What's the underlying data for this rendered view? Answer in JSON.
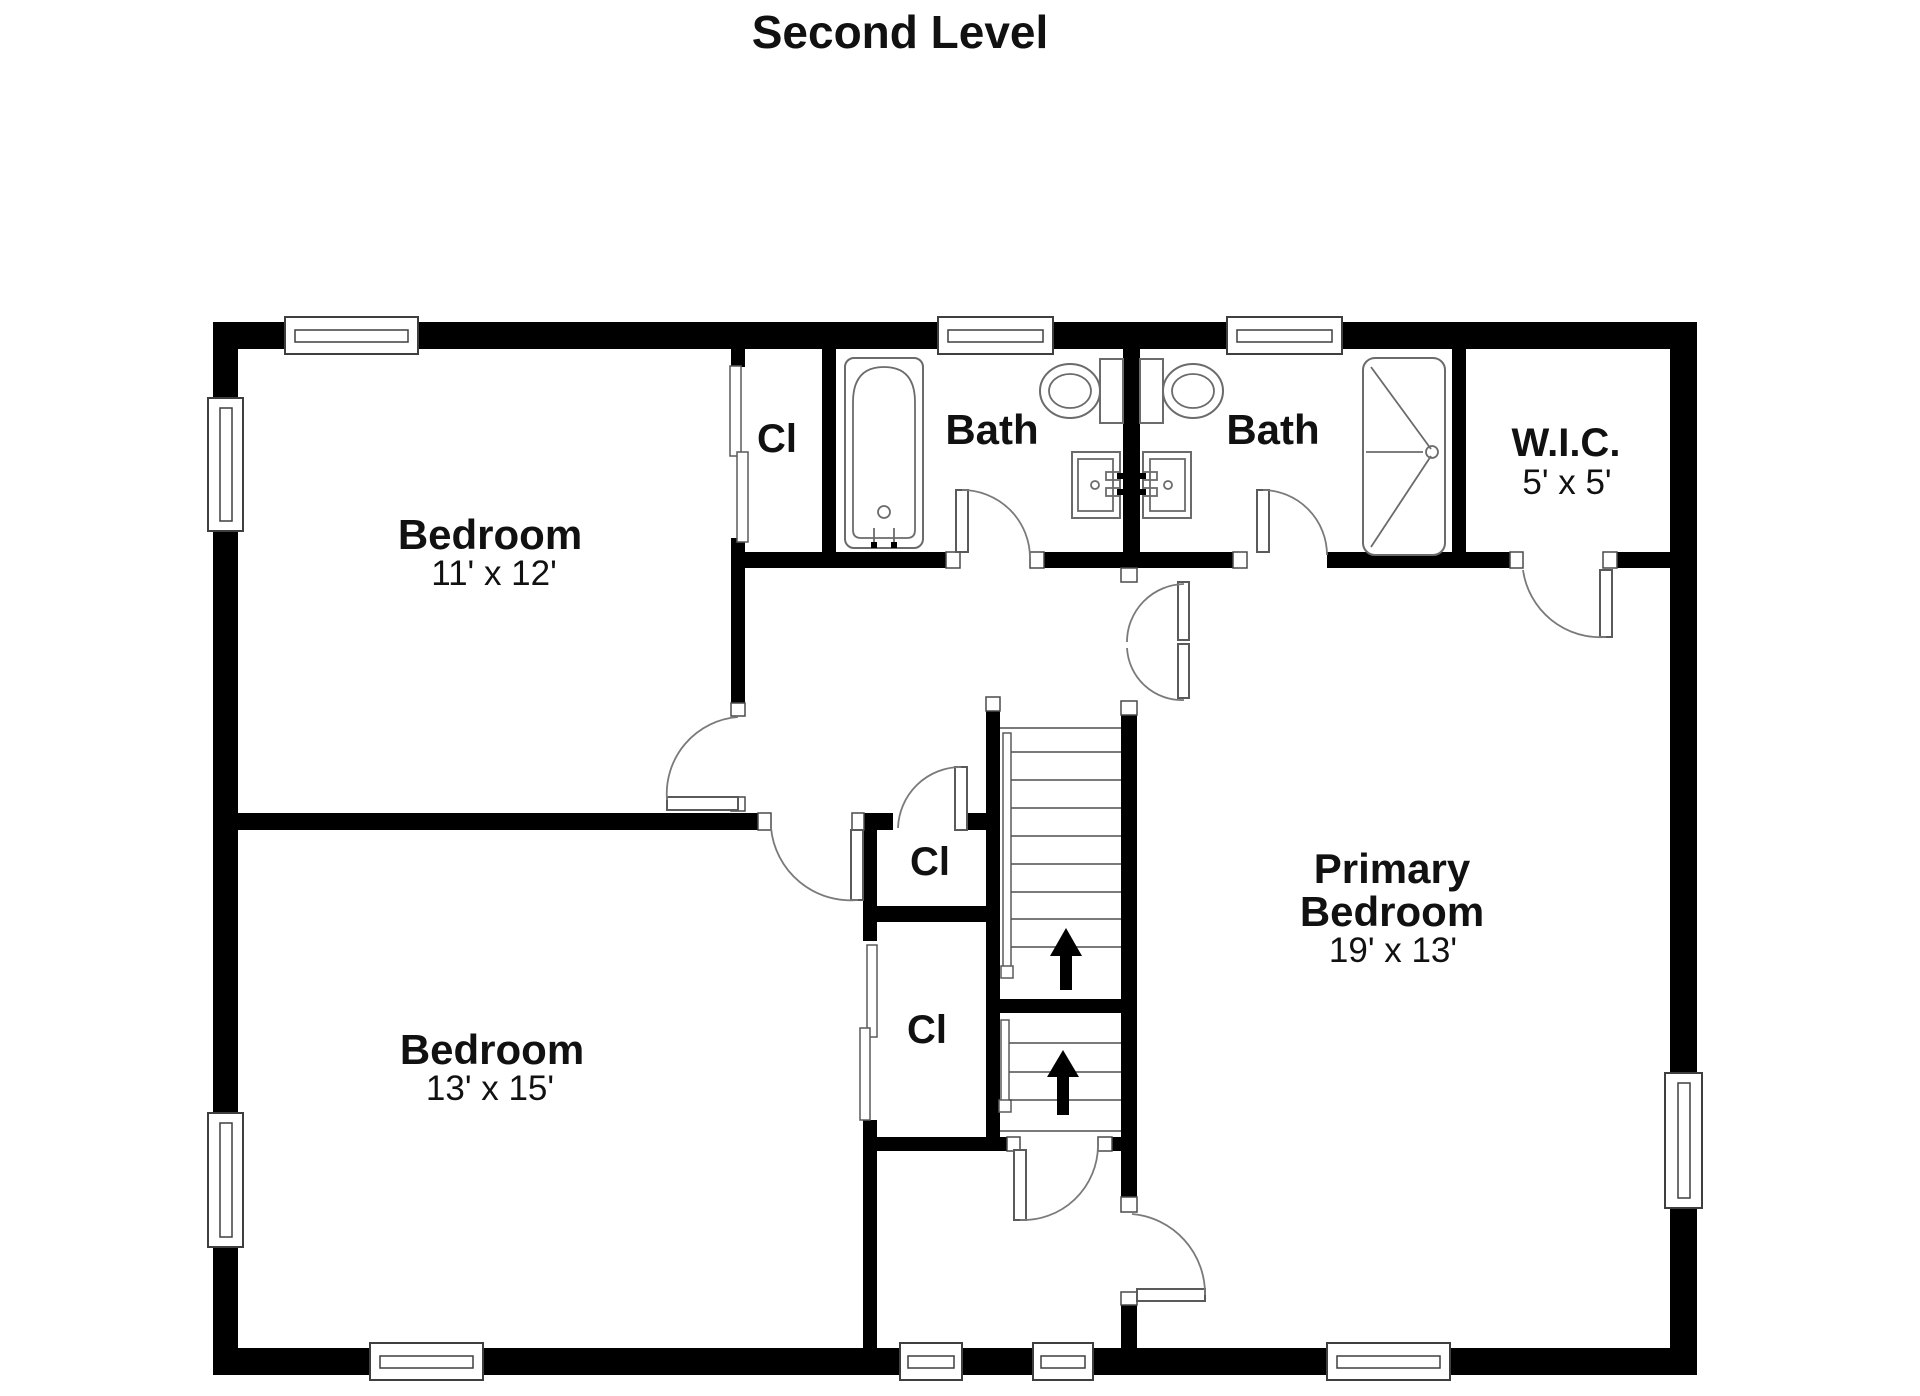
{
  "title": "Second Level",
  "colors": {
    "wall": "#000000",
    "thin_line": "#777777",
    "background": "#ffffff",
    "text": "#111111"
  },
  "rooms": {
    "bedroom_top": {
      "name": "Bedroom",
      "dims": "11' x 12'"
    },
    "bedroom_bottom": {
      "name": "Bedroom",
      "dims": "13' x 15'"
    },
    "primary_bedroom": {
      "line1": "Primary",
      "line2": "Bedroom",
      "dims": "19' x 13'"
    },
    "bath_left": {
      "name": "Bath"
    },
    "bath_right": {
      "name": "Bath"
    },
    "wic": {
      "name": "W.I.C.",
      "dims": "5' x 5'"
    },
    "closet_top": {
      "name": "Cl"
    },
    "closet_mid": {
      "name": "Cl"
    },
    "closet_bottom": {
      "name": "Cl"
    }
  }
}
